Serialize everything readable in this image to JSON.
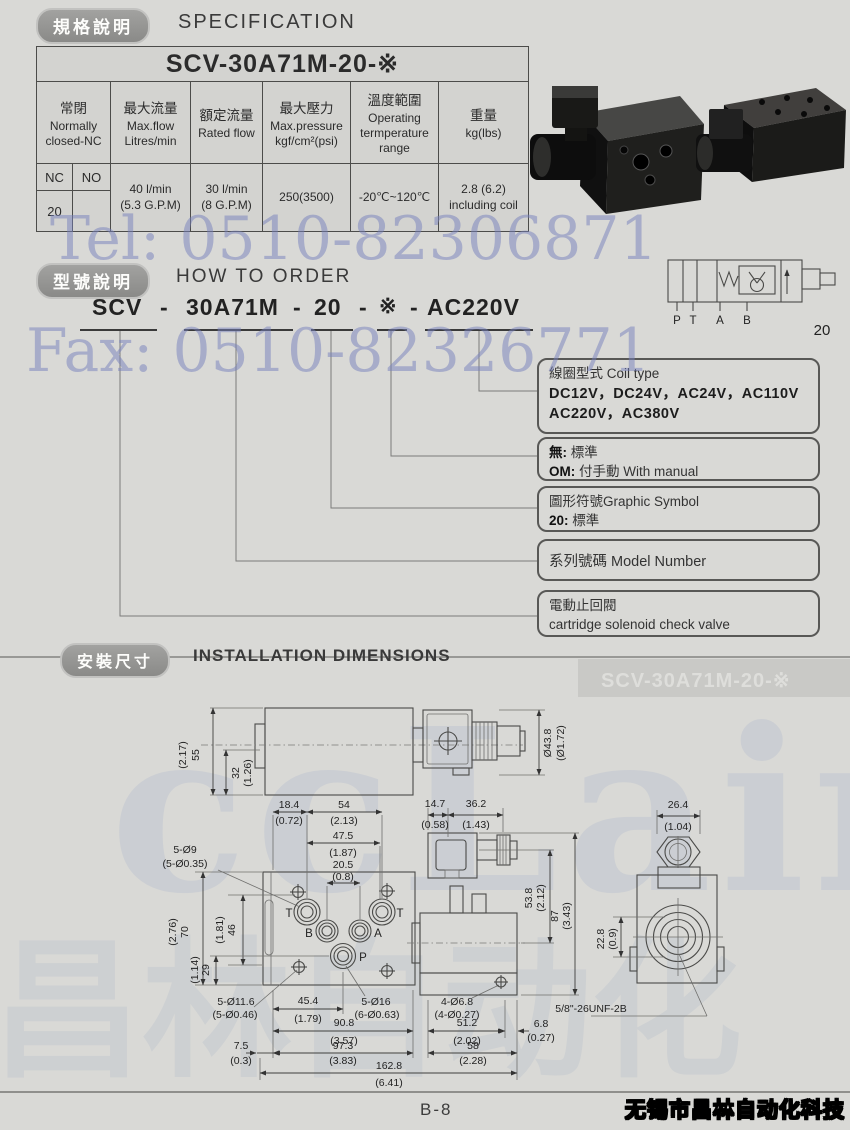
{
  "page": {
    "page_number": "B-8",
    "company": "无锡市昌林自动化科技",
    "tel": "Tel: 0510-82306871",
    "fax": "Fax: 0510-82326771",
    "brand_latin": "ccLair",
    "brand_cjk": "昌林自动化",
    "accent_watermark_color": "#7d80bc"
  },
  "spec": {
    "tag": "規格說明",
    "title": "SPECIFICATION",
    "table": {
      "model": "SCV-30A71M-20-※",
      "headers": [
        {
          "cn": "常閉",
          "en": "Normally closed-NC"
        },
        {
          "cn": "最大流量",
          "en": "Max.flow Litres/min"
        },
        {
          "cn": "額定流量",
          "en": "Rated flow"
        },
        {
          "cn": "最大壓力",
          "en": "Max.pressure kgf/cm²(psi)"
        },
        {
          "cn": "溫度範圍",
          "en": "Operating termperature range"
        },
        {
          "cn": "重量",
          "en": "kg(lbs)"
        }
      ],
      "nc": "NC",
      "no": "NO",
      "nc_value": "20",
      "no_value": "",
      "values": [
        "40 l/min\n(5.3 G.P.M)",
        "30 l/min\n(8 G.P.M)",
        "250(3500)",
        "-20℃~120℃",
        "2.8 (6.2)\nincluding coil"
      ]
    }
  },
  "order": {
    "tag": "型號說明",
    "title": "HOW TO ORDER",
    "model": {
      "p1": "SCV",
      "p2": "30A71M",
      "p3": "20",
      "p4": "※",
      "p5": "AC220V",
      "dash": "-"
    },
    "callouts": {
      "coil": {
        "title": "線圈型式 Coil type",
        "row1": "DC12V，DC24V，AC24V，AC110V",
        "row2": "AC220V，AC380V"
      },
      "manual": {
        "k1": "無:",
        "v1": "標準",
        "k2": "OM:",
        "v2": "付手動 With manual"
      },
      "graphic": {
        "title": "圖形符號Graphic Symbol",
        "k": "20:",
        "v": "標準"
      },
      "series": {
        "title": "系列號碼  Model Number"
      },
      "cartridge": {
        "title": "電動止回閥",
        "sub": "cartridge  solenoid  check valve"
      }
    },
    "symbol": {
      "p": "P",
      "t": "T",
      "a": "A",
      "b": "B",
      "num": "20"
    }
  },
  "install": {
    "tag": "安裝尺寸",
    "title": "INSTALLATION DIMENSIONS",
    "model_wm": "SCV-30A71M-20-※",
    "dims": {
      "d55": "55",
      "d55p": "(2.17)",
      "d32": "32",
      "d32p": "(1.26)",
      "d438": "Ø43.8",
      "d438p": "(Ø1.72)",
      "d184": "18.4",
      "d184p": "(0.72)",
      "d54": "54",
      "d54p": "(2.13)",
      "d475": "47.5",
      "d475p": "(1.87)",
      "d205": "20.5",
      "d205p": "(0.8)",
      "d5d9": "5-Ø9",
      "d5d9p": "(5-Ø0.35)",
      "d147": "14.7",
      "d147p": "(0.58)",
      "d362": "36.2",
      "d362p": "(1.43)",
      "d264": "26.4",
      "d264p": "(1.04)",
      "d70": "70",
      "d70p": "(2.76)",
      "d46": "46",
      "d46p": "(1.81)",
      "d29": "29",
      "d29p": "(1.14)",
      "d538": "53.8",
      "d538p": "(2.12)",
      "d87": "87",
      "d87p": "(3.43)",
      "d228": "22.8",
      "d228p": "(0.9)",
      "d5d116": "5-Ø11.6",
      "d5d116p": "(5-Ø0.46)",
      "d454": "45.4",
      "d454p": "(1.79)",
      "d5d16": "5-Ø16",
      "d5d16p": "(6-Ø0.63)",
      "d4d68": "4-Ø6.8",
      "d4d68p": "(4-Ø0.27)",
      "d908": "90.8",
      "d908p": "(3.57)",
      "d512": "51.2",
      "d512p": "(2.02)",
      "d68": "6.8",
      "d68p": "(0.27)",
      "d75": "7.5",
      "d75p": "(0.3)",
      "d973": "97.3",
      "d973p": "(3.83)",
      "d58": "58",
      "d58p": "(2.28)",
      "d1628": "162.8",
      "d1628p": "(6.41)",
      "thread": "5/8\"-26UNF-2B",
      "portT1": "T",
      "portB": "B",
      "portA": "A",
      "portT2": "T",
      "portP": "P"
    }
  }
}
